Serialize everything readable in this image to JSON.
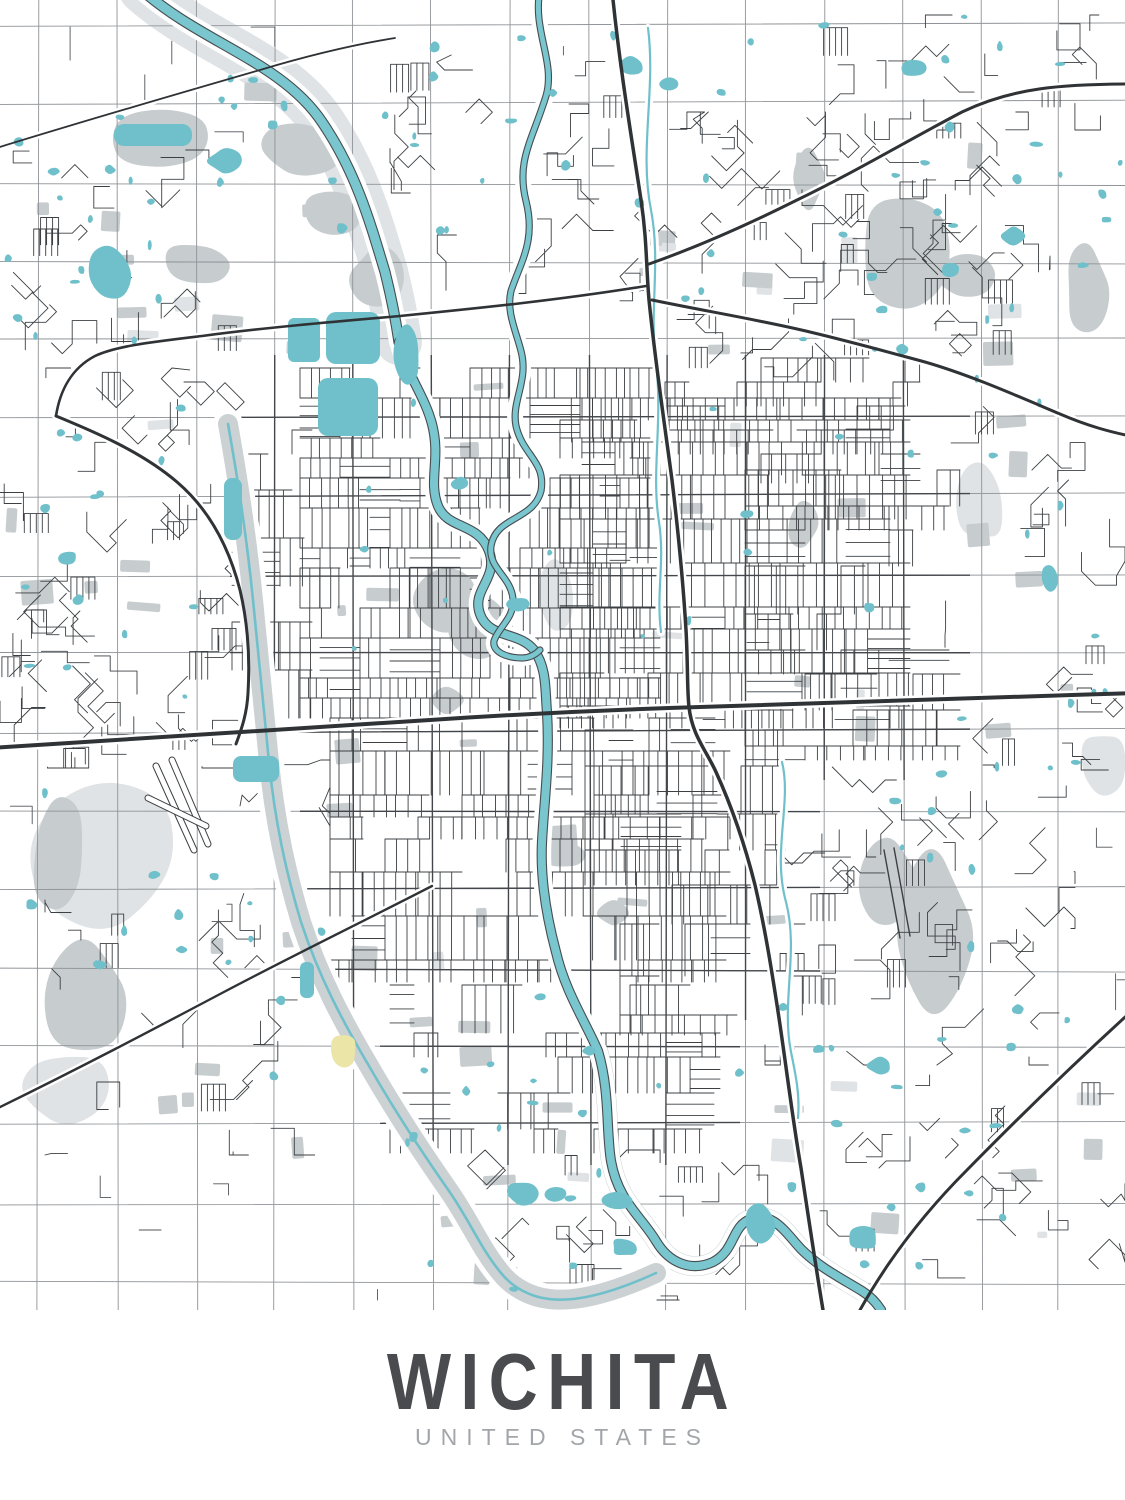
{
  "poster": {
    "title": "WICHITA",
    "subtitle": "UNITED STATES"
  },
  "palette": {
    "background": "#ffffff",
    "water": "#6fc0ca",
    "riverFill": "#79c6cf",
    "waterEdge": "#474c4f",
    "parkGray": "#c7cccf",
    "lightGray": "#dfe3e5",
    "floodwayGray": "#ccd1d4",
    "street": "#3c4043",
    "urbanGrid": "#43474b",
    "sectionLine": "#8f9397",
    "highway": "#2f3336",
    "golfYellow": "#ece5a8",
    "titleColor": "#4a4b4f",
    "subtitleColor": "#a2a6aa"
  },
  "map": {
    "width": 1125,
    "height": 1310,
    "seed": 1337,
    "grid": {
      "x0": 38,
      "xs": 78.6,
      "y0": 26,
      "ys": 78.5
    },
    "urbanClip": [
      {
        "x": 230,
        "y": 355,
        "w": 740,
        "h": 425
      },
      {
        "x": 300,
        "y": 640,
        "w": 520,
        "h": 380
      },
      {
        "x": 380,
        "y": 1005,
        "w": 360,
        "h": 160
      }
    ],
    "rivers": [
      {
        "name": "arkansas-river-upper",
        "w": 9,
        "path": "M142,-10 C200,42 282,62 322,122 C356,172 370,222 385,272 C392,300 396,322 399,342"
      },
      {
        "name": "arkansas-river",
        "w": 8,
        "path": "M399,342 C406,374 424,394 432,424 C441,459 428,481 438,506 C448,530 478,522 489,551 C499,579 471,589 480,614 C489,639 519,631 534,650 C547,668 545,690 547,712 C550,762 544,802 542,842 C540,882 548,922 556,952 C565,991 585,1021 598,1051 C610,1091 606,1131 611,1161 C618,1201 641,1216 656,1241 C669,1263 691,1272 713,1262 C736,1250 731,1226 751,1219 C773,1211 786,1233 801,1249 C819,1267 839,1277 862,1291 C870,1296 876,1302 881,1310"
      },
      {
        "name": "little-arkansas-river",
        "w": 5,
        "path": "M540,-10 C532,30 556,62 546,96 C532,141 516,161 526,201 C536,241 521,261 511,291 C506,311 516,331 521,351 C529,381 511,401 516,426 C523,456 546,461 541,491 C533,521 496,516 491,546 C488,569 511,576 513,599 C514,619 499,626 494,641 C492,652 507,658 522,658 C530,658 536,654 540,650"
      }
    ],
    "creeks": [
      {
        "name": "chisholm-creek",
        "path": "M648,28 C656,90 639,150 651,210 C661,262 649,312 656,362 C663,422 651,472 659,522 C665,562 656,592 661,632"
      },
      {
        "name": "gypsum-creek",
        "path": "M782,762 C792,802 772,852 786,902 C799,952 781,1002 791,1052 C796,1076 800,1096 798,1118"
      }
    ],
    "floodway": {
      "name": "wichita-valley-center-floodway",
      "band": 20,
      "stream": 2.6,
      "path": "M228,424 C238,480 247,540 253,600 C259,660 263,702 269,762 C275,822 286,872 301,922 C319,977 343,1022 369,1066 C396,1113 421,1151 449,1191 C471,1223 481,1249 501,1273 C513,1288 531,1297 549,1299 C581,1303 621,1289 656,1273"
    },
    "bands": [
      {
        "name": "upper-ark-floodplain",
        "color": "#dfe3e5",
        "w": 46,
        "path": "M142,-10 C200,42 282,62 322,122 C356,172 370,222 385,272 C392,300 396,322 399,342"
      },
      {
        "name": "little-ark-corridor",
        "color": "#d9dde0",
        "w": 14,
        "path": "M540,-10 C532,30 556,62 546,96 C532,141 516,161 526,201 C536,241 521,261 511,291"
      },
      {
        "name": "riverside-corridor",
        "color": "#d4d8db",
        "w": 18,
        "path": "M432,424 C441,459 428,481 438,506 C448,530 478,522 489,551 C499,579 471,589 480,614 C489,639 519,631 534,650"
      },
      {
        "name": "floodway-south-band",
        "color": "#ccd1d4",
        "w": 24,
        "path": "M369,1066 C396,1113 421,1151 449,1191 C471,1223 481,1249 501,1273 C513,1288 531,1297 549,1299 C581,1303 621,1289 656,1273"
      },
      {
        "name": "river-south-band",
        "color": "#ccd1d4",
        "w": 20,
        "path": "M598,1051 C610,1091 606,1131 611,1161 C618,1201 641,1216 656,1241 C669,1263 691,1272 713,1262 C736,1250 731,1226 751,1219 C773,1211 786,1233 801,1249 C819,1267 839,1277 862,1291"
      }
    ],
    "parkBlobs": [
      {
        "x": 105,
        "y": 108,
        "w": 115,
        "h": 62
      },
      {
        "x": 252,
        "y": 118,
        "w": 88,
        "h": 56
      },
      {
        "x": 300,
        "y": 192,
        "w": 66,
        "h": 46
      },
      {
        "x": 162,
        "y": 243,
        "w": 68,
        "h": 44
      },
      {
        "x": 352,
        "y": 248,
        "w": 52,
        "h": 58
      },
      {
        "x": 418,
        "y": 568,
        "w": 62,
        "h": 62
      },
      {
        "x": 452,
        "y": 596,
        "w": 64,
        "h": 66
      },
      {
        "x": 30,
        "y": 793,
        "w": 56,
        "h": 112
      },
      {
        "x": 42,
        "y": 938,
        "w": 86,
        "h": 118
      },
      {
        "x": 860,
        "y": 836,
        "w": 58,
        "h": 100
      },
      {
        "x": 893,
        "y": 853,
        "w": 80,
        "h": 160
      },
      {
        "x": 862,
        "y": 193,
        "w": 96,
        "h": 114
      },
      {
        "x": 933,
        "y": 252,
        "w": 58,
        "h": 46
      },
      {
        "x": 543,
        "y": 840,
        "w": 42,
        "h": 28
      },
      {
        "x": 430,
        "y": 688,
        "w": 32,
        "h": 24
      },
      {
        "x": 788,
        "y": 503,
        "w": 28,
        "h": 42
      },
      {
        "x": 1066,
        "y": 248,
        "w": 42,
        "h": 86
      },
      {
        "x": 598,
        "y": 903,
        "w": 32,
        "h": 22
      },
      {
        "x": 793,
        "y": 148,
        "w": 32,
        "h": 60
      }
    ],
    "lightBlobs": [
      {
        "x": 22,
        "y": 778,
        "w": 168,
        "h": 148
      },
      {
        "x": 18,
        "y": 1052,
        "w": 92,
        "h": 72
      },
      {
        "x": 536,
        "y": 556,
        "w": 36,
        "h": 74
      },
      {
        "x": 1078,
        "y": 732,
        "w": 48,
        "h": 62
      },
      {
        "x": 955,
        "y": 455,
        "w": 50,
        "h": 90
      }
    ],
    "highways": [
      {
        "name": "us-54-kellogg",
        "w": 4,
        "path": "M-10,748 C150,739 300,728 430,720 C520,714 600,710 700,707 C820,703 980,698 1135,693"
      },
      {
        "name": "i-135",
        "w": 3.5,
        "path": "M612,-10 C620,70 632,140 641,200 C647,240 646,265 649,300 C655,360 664,420 672,480 C678,530 683,580 686,630 C688,665 687,690 689,707 C692,735 706,750 716,772 C731,805 745,845 755,885 C765,928 772,972 779,1018 C787,1072 793,1122 801,1168 C808,1214 815,1262 823,1310"
      },
      {
        "name": "k-254-northeast",
        "w": 3,
        "path": "M649,264 C700,246 745,226 795,201 C855,172 905,142 962,112 C1012,88 1060,84 1135,84"
      },
      {
        "name": "k-96-east",
        "w": 3,
        "path": "M652,300 C710,312 760,320 810,332 C860,344 895,354 925,362 C970,375 1015,395 1060,414 C1088,426 1110,432 1135,437"
      },
      {
        "name": "k-96-west",
        "w": 2.6,
        "path": "M646,286 C560,300 480,308 400,316 C330,322 262,328 202,336 C152,342 116,346 95,356 C72,368 60,390 56,416"
      },
      {
        "name": "i-235-loop",
        "w": 3,
        "path": "M56,416 C95,432 142,452 177,482 C211,511 230,551 240,590 C248,624 250,660 248,693 C247,713 242,728 236,744"
      },
      {
        "name": "k-42-southwest",
        "w": 2.4,
        "path": "M432,886 C362,922 292,956 222,993 C152,1030 80,1068 -10,1112"
      },
      {
        "name": "kansas-turnpike",
        "w": 3,
        "path": "M1135,1008 C1080,1058 1022,1114 967,1170 C922,1215 888,1260 860,1310"
      },
      {
        "name": "nw-rail-diagonal",
        "w": 1.8,
        "path": "M-10,150 C80,122 170,96 260,70 C310,55 352,45 395,38"
      }
    ],
    "lakes": [
      {
        "name": "sedgwick-park-lake-1",
        "t": "rr",
        "x": 288,
        "y": 318,
        "w": 32,
        "h": 44,
        "r": 6
      },
      {
        "name": "sedgwick-park-lake-2",
        "t": "rr",
        "x": 326,
        "y": 312,
        "w": 54,
        "h": 52,
        "r": 10
      },
      {
        "name": "sedgwick-park-lake-3",
        "t": "rr",
        "x": 318,
        "y": 378,
        "w": 60,
        "h": 58,
        "r": 10
      },
      {
        "name": "sedgwick-park-lake-4",
        "t": "b",
        "x": 394,
        "y": 326,
        "w": 26,
        "h": 58
      },
      {
        "name": "nw-long-lake",
        "t": "rr",
        "x": 114,
        "y": 124,
        "w": 78,
        "h": 22,
        "r": 10
      },
      {
        "name": "nw-lake-2",
        "t": "b",
        "x": 88,
        "y": 248,
        "w": 40,
        "h": 54
      },
      {
        "name": "nw-lake-3",
        "t": "b",
        "x": 208,
        "y": 150,
        "w": 34,
        "h": 22
      },
      {
        "name": "floodway-lake",
        "t": "rr",
        "x": 224,
        "y": 478,
        "w": 18,
        "h": 62,
        "r": 8
      },
      {
        "name": "airport-pond",
        "t": "rr",
        "x": 233,
        "y": 756,
        "w": 46,
        "h": 26,
        "r": 8
      },
      {
        "name": "south-pond-1",
        "t": "b",
        "x": 506,
        "y": 1182,
        "w": 30,
        "h": 22
      },
      {
        "name": "south-pond-2",
        "t": "b",
        "x": 544,
        "y": 1188,
        "w": 22,
        "h": 14
      },
      {
        "name": "south-pond-3",
        "t": "b",
        "x": 600,
        "y": 1192,
        "w": 32,
        "h": 16
      },
      {
        "name": "south-pond-4",
        "t": "b",
        "x": 612,
        "y": 1238,
        "w": 26,
        "h": 18
      },
      {
        "name": "south-pond-5",
        "t": "b",
        "x": 744,
        "y": 1206,
        "w": 32,
        "h": 42
      },
      {
        "name": "south-pond-6",
        "t": "b",
        "x": 846,
        "y": 1226,
        "w": 32,
        "h": 24
      },
      {
        "name": "se-pond",
        "t": "b",
        "x": 868,
        "y": 1058,
        "w": 24,
        "h": 16
      },
      {
        "name": "east-pond",
        "t": "b",
        "x": 1042,
        "y": 566,
        "w": 16,
        "h": 26
      },
      {
        "name": "ne-pond-1",
        "t": "b",
        "x": 902,
        "y": 60,
        "w": 26,
        "h": 16
      },
      {
        "name": "ne-pond-2",
        "t": "b",
        "x": 1002,
        "y": 228,
        "w": 22,
        "h": 16
      },
      {
        "name": "ne-pond-3",
        "t": "b",
        "x": 942,
        "y": 264,
        "w": 18,
        "h": 12
      },
      {
        "name": "north-pond-1",
        "t": "b",
        "x": 616,
        "y": 56,
        "w": 28,
        "h": 18
      },
      {
        "name": "north-pond-2",
        "t": "b",
        "x": 660,
        "y": 78,
        "w": 18,
        "h": 12
      },
      {
        "name": "west-pond",
        "t": "b",
        "x": 58,
        "y": 552,
        "w": 18,
        "h": 12
      },
      {
        "name": "sw-canal-pond",
        "t": "rr",
        "x": 300,
        "y": 962,
        "w": 14,
        "h": 36,
        "r": 6
      },
      {
        "name": "meander-pond-1",
        "t": "b",
        "x": 452,
        "y": 478,
        "w": 16,
        "h": 12
      },
      {
        "name": "meander-pond-2",
        "t": "b",
        "x": 508,
        "y": 598,
        "w": 20,
        "h": 14
      }
    ],
    "pondFields": [
      {
        "x": 0,
        "y": 60,
        "w": 370,
        "h": 300,
        "n": 26
      },
      {
        "x": 380,
        "y": 15,
        "w": 380,
        "h": 290,
        "n": 20
      },
      {
        "x": 770,
        "y": 15,
        "w": 355,
        "h": 370,
        "n": 26
      },
      {
        "x": 0,
        "y": 400,
        "w": 250,
        "h": 370,
        "n": 14
      },
      {
        "x": 945,
        "y": 390,
        "w": 180,
        "h": 390,
        "n": 10
      },
      {
        "x": 770,
        "y": 760,
        "w": 350,
        "h": 300,
        "n": 16
      },
      {
        "x": 50,
        "y": 890,
        "w": 280,
        "h": 260,
        "n": 8
      },
      {
        "x": 390,
        "y": 990,
        "w": 410,
        "h": 310,
        "n": 20
      },
      {
        "x": 620,
        "y": 370,
        "w": 330,
        "h": 370,
        "n": 8
      },
      {
        "x": 270,
        "y": 370,
        "w": 360,
        "h": 290,
        "n": 6
      },
      {
        "x": 0,
        "y": 775,
        "w": 240,
        "h": 190,
        "n": 6
      },
      {
        "x": 830,
        "y": 1070,
        "w": 290,
        "h": 220,
        "n": 10
      }
    ],
    "patchFields": [
      {
        "x": 0,
        "y": 70,
        "w": 380,
        "h": 290,
        "n": 10
      },
      {
        "x": 630,
        "y": 110,
        "w": 490,
        "h": 290,
        "n": 12
      },
      {
        "x": 945,
        "y": 410,
        "w": 180,
        "h": 350,
        "n": 6
      },
      {
        "x": 310,
        "y": 370,
        "w": 650,
        "h": 400,
        "n": 14
      },
      {
        "x": 310,
        "y": 790,
        "w": 490,
        "h": 290,
        "n": 10
      },
      {
        "x": 50,
        "y": 890,
        "w": 290,
        "h": 290,
        "n": 6
      },
      {
        "x": 440,
        "y": 1090,
        "w": 390,
        "h": 200,
        "n": 8
      },
      {
        "x": 0,
        "y": 410,
        "w": 250,
        "h": 360,
        "n": 6
      },
      {
        "x": 830,
        "y": 1070,
        "w": 290,
        "h": 200,
        "n": 6
      }
    ],
    "districts": [
      {
        "x": 300,
        "y": 368,
        "w": 360,
        "h": 350,
        "style": "grid",
        "cell": 10,
        "cov": 0.92
      },
      {
        "x": 560,
        "y": 398,
        "w": 350,
        "h": 330,
        "style": "grid",
        "cell": 11,
        "cov": 0.85
      },
      {
        "x": 330,
        "y": 718,
        "w": 400,
        "h": 265,
        "style": "grid",
        "cell": 11,
        "cov": 0.85
      },
      {
        "x": 585,
        "y": 730,
        "w": 200,
        "h": 155,
        "style": "grid",
        "cell": 12,
        "cov": 0.7
      },
      {
        "x": 665,
        "y": 358,
        "w": 255,
        "h": 125,
        "style": "grid",
        "cell": 12,
        "cov": 0.65
      },
      {
        "x": 745,
        "y": 470,
        "w": 215,
        "h": 290,
        "style": "grid",
        "cell": 12,
        "cov": 0.6
      },
      {
        "x": 390,
        "y": 985,
        "w": 330,
        "h": 168,
        "style": "grid",
        "cell": 12,
        "cov": 0.6
      },
      {
        "x": 620,
        "y": 885,
        "w": 185,
        "h": 150,
        "style": "grid",
        "cell": 13,
        "cov": 0.55
      },
      {
        "x": 232,
        "y": 430,
        "w": 80,
        "h": 300,
        "style": "grid",
        "cell": 12,
        "cov": 0.5
      },
      {
        "x": 240,
        "y": 760,
        "w": 90,
        "h": 220,
        "style": "suburb",
        "cell": 0,
        "cov": 0.5
      },
      {
        "x": 0,
        "y": 368,
        "w": 245,
        "h": 400,
        "style": "suburb",
        "cell": 0,
        "cov": 0.8
      },
      {
        "x": 0,
        "y": 150,
        "w": 270,
        "h": 215,
        "style": "suburb",
        "cell": 0,
        "cov": 0.45
      },
      {
        "x": 620,
        "y": 112,
        "w": 430,
        "h": 268,
        "style": "suburb",
        "cell": 0,
        "cov": 0.75
      },
      {
        "x": 390,
        "y": 55,
        "w": 250,
        "h": 240,
        "style": "suburb",
        "cell": 0,
        "cov": 0.5
      },
      {
        "x": 780,
        "y": 15,
        "w": 345,
        "h": 115,
        "style": "suburb",
        "cell": 0,
        "cov": 0.4
      },
      {
        "x": 945,
        "y": 385,
        "w": 180,
        "h": 385,
        "style": "suburb",
        "cell": 0,
        "cov": 0.35
      },
      {
        "x": 765,
        "y": 765,
        "w": 310,
        "h": 300,
        "style": "suburb",
        "cell": 0,
        "cov": 0.6
      },
      {
        "x": 45,
        "y": 900,
        "w": 270,
        "h": 255,
        "style": "suburb",
        "cell": 0,
        "cov": 0.35
      },
      {
        "x": 440,
        "y": 1150,
        "w": 330,
        "h": 150,
        "style": "suburb",
        "cell": 0,
        "cov": 0.5
      },
      {
        "x": 820,
        "y": 1065,
        "w": 305,
        "h": 235,
        "style": "suburb",
        "cell": 0,
        "cov": 0.35
      },
      {
        "x": 0,
        "y": 0,
        "w": 380,
        "h": 142,
        "style": "rural",
        "cell": 0,
        "cov": 0.6
      },
      {
        "x": 0,
        "y": 768,
        "w": 232,
        "h": 195,
        "style": "rural",
        "cell": 0,
        "cov": 0.5
      },
      {
        "x": 970,
        "y": 780,
        "w": 155,
        "h": 380,
        "style": "rural",
        "cell": 0,
        "cov": 0.5
      },
      {
        "x": 60,
        "y": 1160,
        "w": 300,
        "h": 140,
        "style": "rural",
        "cell": 0,
        "cov": 0.5
      },
      {
        "x": 300,
        "y": 1160,
        "w": 150,
        "h": 140,
        "style": "rural",
        "cell": 0,
        "cov": 0.4
      },
      {
        "x": 1050,
        "y": 0,
        "w": 75,
        "h": 142,
        "style": "rural",
        "cell": 0,
        "cov": 0.5
      },
      {
        "x": 380,
        "y": 0,
        "w": 390,
        "h": 55,
        "style": "rural",
        "cell": 0,
        "cov": 0.4
      }
    ],
    "specials": {
      "golfPatch": {
        "x": 331,
        "y": 1036,
        "w": 26,
        "h": 32
      },
      "airportRunways": [
        [
          156,
          766,
          194,
          850
        ],
        [
          172,
          760,
          208,
          844
        ],
        [
          148,
          798,
          206,
          826
        ]
      ],
      "afbRunways": [
        [
          884,
          850,
          900,
          938
        ],
        [
          894,
          848,
          910,
          936
        ]
      ]
    }
  }
}
